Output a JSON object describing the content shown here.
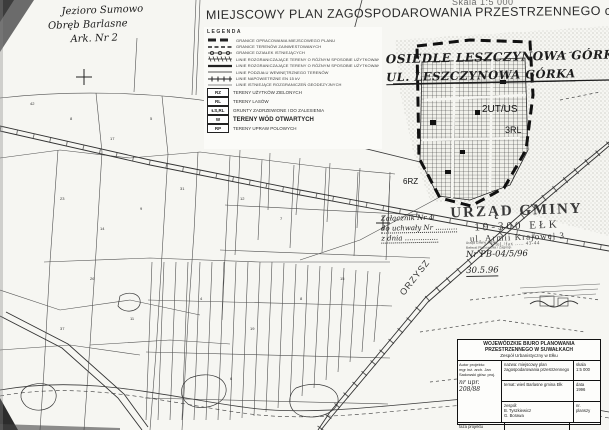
{
  "page": {
    "title": "MIEJSCOWY PLAN ZAGOSPODAROWANIA PRZESTRZENNEGO części WSI",
    "scale_note": "Skala 1:5 000"
  },
  "handwritten_header": {
    "line1": "Jezioro Sumowo",
    "line2": "Obręb Barlasne",
    "line3": "Ark. Nr 2"
  },
  "annotations": {
    "osiedle_line1": "OSIEDLE LESZCZYNOWA GÓRKA",
    "osiedle_line2": "UL. LESZCZYNOWA GÓRKA",
    "zalacznik_line1": "Załącznik Nr 4",
    "zalacznik_line2": "do uchwały Nr ..........",
    "zalacznik_line3": "z dnia ..............."
  },
  "legend": {
    "heading": "LEGENDA",
    "line_items": [
      "GRANICE OPRACOWANIA MIEJSCOWEGO PLANU",
      "GRANICE TERENÓW ZAINWESTOWANYCH",
      "GRANICE DZIAŁEK ISTNIEJĄCYCH",
      "LINIE ROZGRANICZAJĄCE TERENY O RÓŻNYM SPOSOBIE UŻYTKOWANIA ŚCIŚLE OKREŚLONE",
      "LINIE ROZGRANICZAJĄCE TERENY O RÓŻNYM SPOSOBIE UŻYTKOWANIA ORIENTACYJNE",
      "LINIE PODZIAŁU WEWNĘTRZNEGO TERENÓW",
      "LINIE NAPOWIETRZNE EN 15 kV",
      "LINIE ISTNIEJĄCE ROZGRANICZEŃ GEODEZYJNYCH"
    ],
    "coded_items": [
      {
        "code": "RZ",
        "label": "TERENY UŻYTKÓW ZIELONYCH"
      },
      {
        "code": "RL",
        "label": "TERENY LASÓW"
      },
      {
        "code": "ŁS,RL",
        "label": "GRUNTY ZADRZEWIONE I DO ZALESIENIA"
      },
      {
        "code": "W",
        "label": "TERENY WÓD OTWARTYCH"
      },
      {
        "code": "RP",
        "label": "TERENY UPRAW POLOWYCH"
      }
    ]
  },
  "map_labels": [
    {
      "text": "2UT/US"
    },
    {
      "text": "3RL"
    },
    {
      "text": "6RZ"
    },
    {
      "text": "ORZYSZ"
    }
  ],
  "parcel_numbers": [
    "42",
    "8",
    "17",
    "5",
    "23",
    "14",
    "9",
    "31",
    "12",
    "7",
    "26",
    "11",
    "4",
    "19",
    "8",
    "37",
    "6",
    "15"
  ],
  "stamp": {
    "line1": "URZĄD GMINY",
    "line2": "19-300 EŁK",
    "line3": "ul. Armii Krajowej 3",
    "line4": "tel./fax ..... 43-44"
  },
  "stamp_small": {
    "line1": "Urząd Gminy w Ełku",
    "line2": "Referat Planowania i Zagosp.",
    "number": "Nr PB-04/5/96",
    "date": "30.5.96"
  },
  "title_block": {
    "org_line1": "WOJEWÓDZKIE BIURO PLANOWANIA",
    "org_line2": "PRZESTRZENNEGO W SUWAŁKACH",
    "org_line3": "Zespół Urbanistyczny w Ełku",
    "author_label": "Autor projektu:",
    "author_line1": "mgr inż. arch. Jan",
    "author_line2": "Sadowski głów. proj.",
    "author_handwritten": "nr upr. 208/88",
    "nazwa": "nazwa: miejscowy plan zagospodarowania przestrzennego",
    "skala_label": "skala",
    "skala_value": "1:5 000",
    "temat": "temat: wieś Barlasne gmina Ełk",
    "data_label": "data",
    "data_value": "1996",
    "faza": "faza projektu",
    "zespol_label": "zespół:",
    "zespol_line1": "B. Tyszkiewicz",
    "zespol_line2": "G. Borawa",
    "nr_label": "nr.",
    "nr_value": "planszy"
  }
}
